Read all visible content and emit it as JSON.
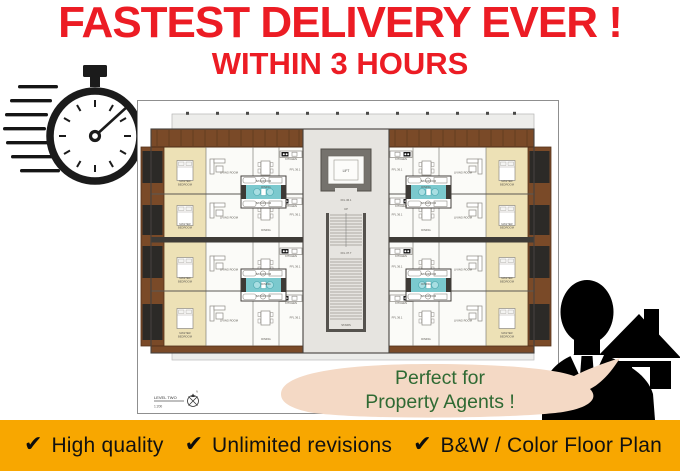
{
  "header": {
    "title": "FASTEST DELIVERY EVER !",
    "subtitle": "WITHIN 3 HOURS",
    "text_color": "#EC1C24"
  },
  "floor_plan": {
    "sheet_title": "LEVEL TWO",
    "sheet_scale": "1:200",
    "north_letter": "N",
    "rooms": {
      "master_line1": "MASTER",
      "master_line2": "BEDROOM",
      "living": "LIVING ROOM",
      "dining": "DINING",
      "kitchen": "KITCHEN",
      "bathroom": "BATHROOM"
    },
    "core": {
      "lift": "LIFT",
      "up": "UP",
      "stairs": "STAIRS",
      "ffl_unit": "FFL 36.1",
      "ffl_stairs": "FFL 37.7"
    },
    "colors": {
      "wood": "#7A4A28",
      "bedroom_fill": "#EDE1B6",
      "bathroom_fill": "#7BC9CE",
      "core_fill": "#E6E4E0"
    }
  },
  "speech_bubble": {
    "line1": "Perfect for",
    "line2": "Property Agents !",
    "bg": "#F4D9C5",
    "text_color": "#2F6A33"
  },
  "banner": {
    "bg": "#F8A700",
    "check_glyph": "✔",
    "items": [
      {
        "label": "High quality"
      },
      {
        "label": "Unlimited revisions"
      },
      {
        "label": "B&W / Color Floor Plan"
      }
    ]
  }
}
